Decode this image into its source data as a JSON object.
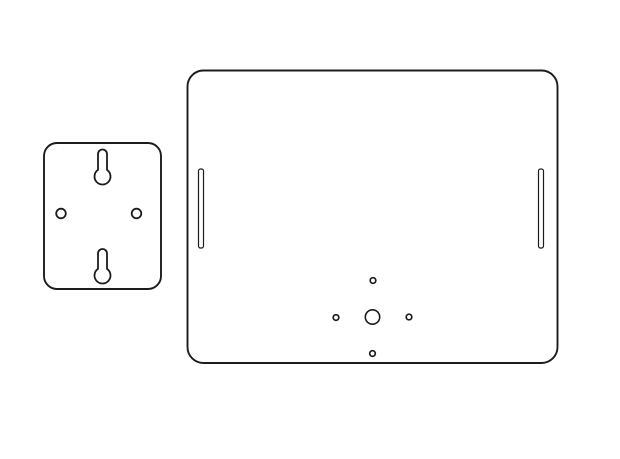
{
  "canvas": {
    "width": 620,
    "height": 459
  },
  "colors": {
    "background": "#ffffff",
    "line": "#1c1c1c"
  },
  "diagram": {
    "kind": "technical-line-drawing",
    "description": "Two mounting plate outlines: small wall bracket and large backing plate",
    "parts": [
      {
        "id": "wall-bracket-plate",
        "shape": "rounded-rect",
        "x": 44,
        "y": 143,
        "width": 117,
        "height": 146,
        "corner_radius": 13,
        "stroke_width": 1.9,
        "features": [
          {
            "id": "top-keyhole-slot",
            "type": "keyhole",
            "cx": 102.5,
            "slot_half_width": 4.5,
            "cap_top_y": 149.5,
            "bulb_cy": 176.5,
            "bulb_r": 8,
            "stroke_width": 1.8
          },
          {
            "id": "bottom-keyhole-slot",
            "type": "keyhole",
            "cx": 102.5,
            "slot_half_width": 4.5,
            "cap_top_y": 249,
            "bulb_cy": 275.5,
            "bulb_r": 8,
            "stroke_width": 1.8
          },
          {
            "id": "left-screw-hole",
            "type": "circle",
            "cx": 61,
            "cy": 213.5,
            "r": 4.8,
            "stroke_width": 1.8
          },
          {
            "id": "right-screw-hole",
            "type": "circle",
            "cx": 136.5,
            "cy": 213.5,
            "r": 4.8,
            "stroke_width": 1.8
          }
        ]
      },
      {
        "id": "backing-plate",
        "shape": "rounded-rect",
        "x": 187.5,
        "y": 70.5,
        "width": 370,
        "height": 292.5,
        "corner_radius": 16,
        "stroke_width": 1.9,
        "features": [
          {
            "id": "left-edge-slot",
            "type": "slot-rect",
            "x": 198.5,
            "y": 169,
            "width": 5,
            "height": 79,
            "rx": 2,
            "stroke_width": 1.2
          },
          {
            "id": "right-edge-slot",
            "type": "slot-rect",
            "x": 538.5,
            "y": 169,
            "width": 5,
            "height": 79,
            "rx": 2,
            "stroke_width": 1.2
          },
          {
            "id": "center-hole",
            "type": "circle",
            "cx": 372.5,
            "cy": 317,
            "r": 7.2,
            "stroke_width": 1.6
          },
          {
            "id": "top-small-hole",
            "type": "circle",
            "cx": 373,
            "cy": 280.5,
            "r": 2.8,
            "stroke_width": 1.7
          },
          {
            "id": "left-small-hole",
            "type": "circle",
            "cx": 336,
            "cy": 317.5,
            "r": 2.8,
            "stroke_width": 1.7
          },
          {
            "id": "right-small-hole",
            "type": "circle",
            "cx": 409,
            "cy": 317,
            "r": 2.8,
            "stroke_width": 1.7
          },
          {
            "id": "bottom-small-hole",
            "type": "circle",
            "cx": 372.5,
            "cy": 353.5,
            "r": 2.8,
            "stroke_width": 1.7
          }
        ]
      }
    ]
  }
}
